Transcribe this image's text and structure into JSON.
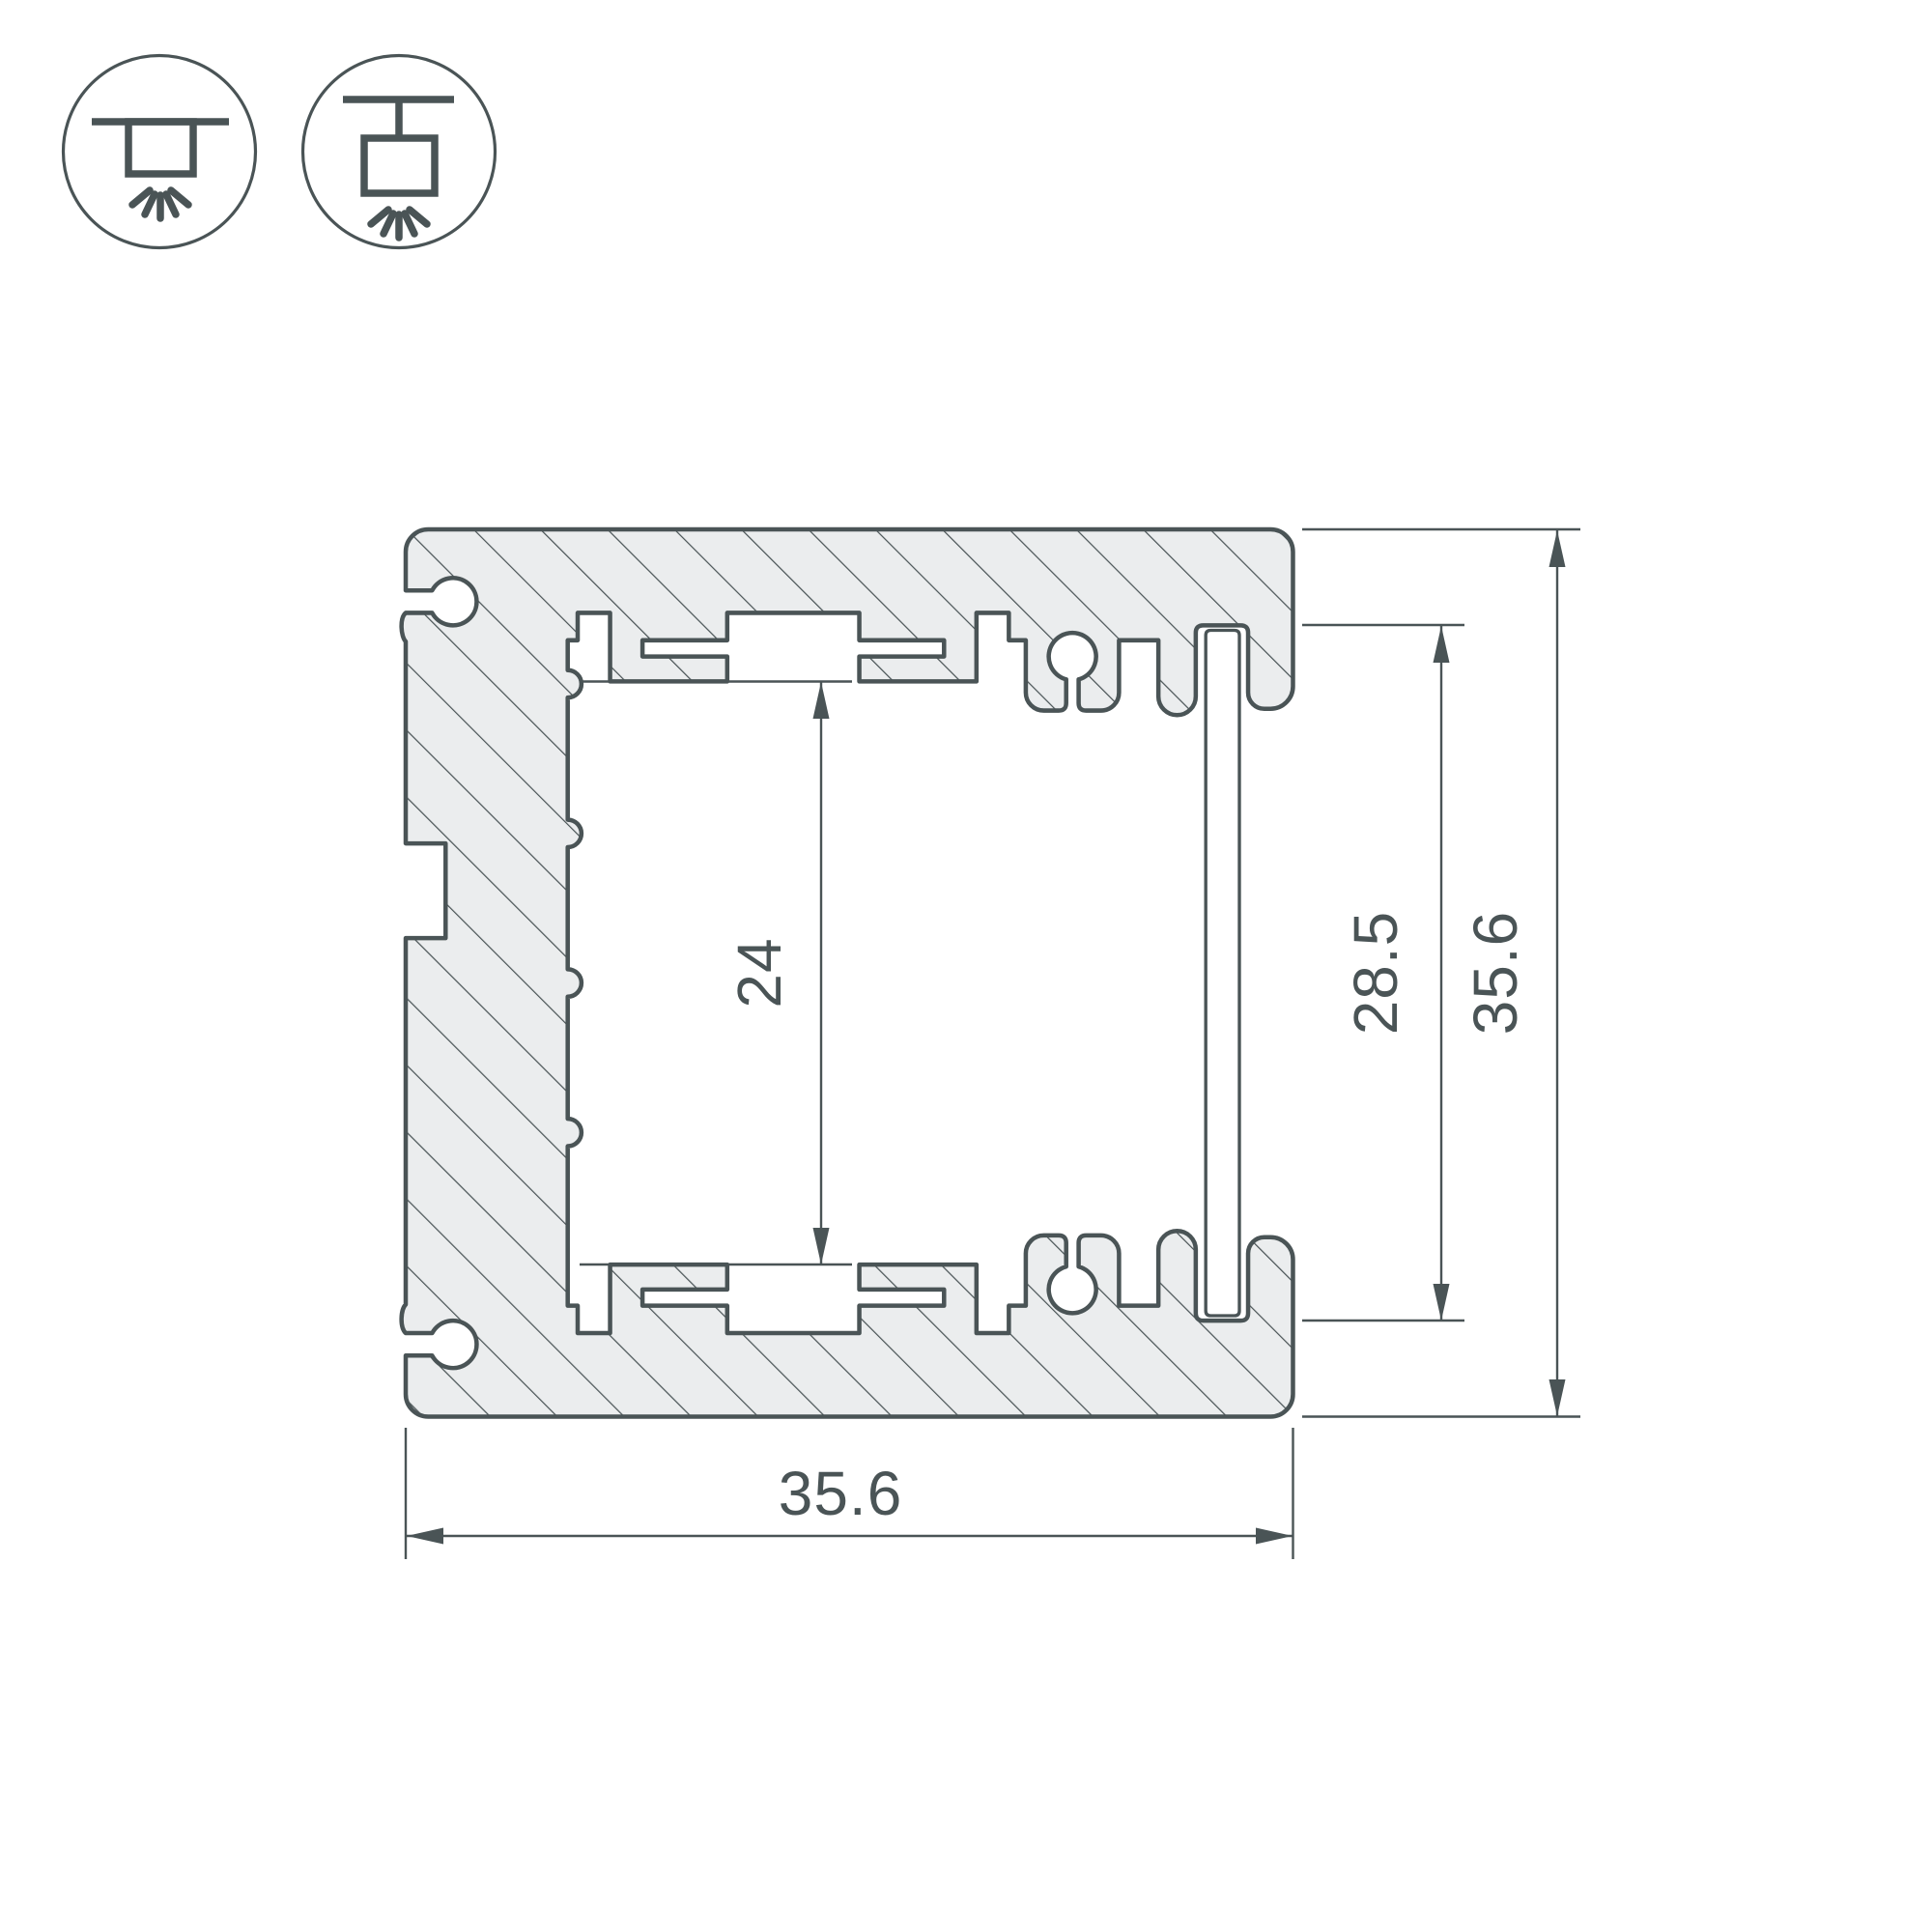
{
  "page": {
    "background": "#ffffff",
    "line_color": "#4a5456",
    "metal_fill": "#ebedee",
    "description": "Aluminium LED profile cross-section technical drawing"
  },
  "icons": [
    {
      "name": "surface-mount-light-icon"
    },
    {
      "name": "pendant-mount-light-icon"
    }
  ],
  "dimensions": {
    "inner_label": "24",
    "opening_label": "28.5",
    "height_label": "35.6",
    "width_label": "35.6"
  }
}
